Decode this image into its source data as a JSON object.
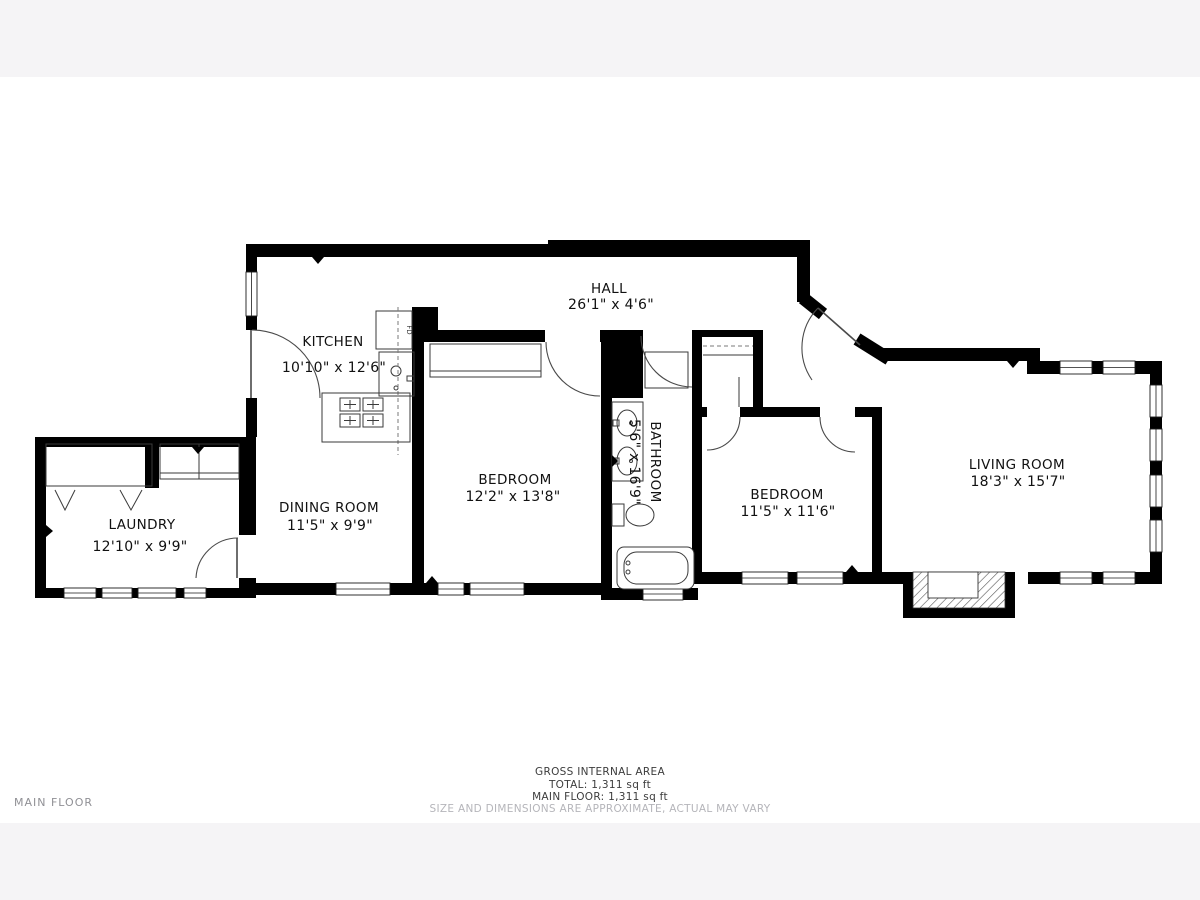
{
  "colors": {
    "page_bg": "#f5f4f6",
    "canvas_bg": "#ffffff",
    "wall": "#000000",
    "label": "#111111",
    "muted_label": "#909095",
    "disclaimer": "#b5b5ba"
  },
  "rooms": {
    "kitchen": {
      "name": "KITCHEN",
      "dims": "10'10\" x 12'6\""
    },
    "hall": {
      "name": "HALL",
      "dims": "26'1\" x 4'6\""
    },
    "laundry": {
      "name": "LAUNDRY",
      "dims": "12'10\" x 9'9\""
    },
    "dining": {
      "name": "DINING ROOM",
      "dims": "11'5\" x 9'9\""
    },
    "bedroom1": {
      "name": "BEDROOM",
      "dims": "12'2\" x 13'8\""
    },
    "bathroom": {
      "name": "BATHROOM",
      "dims": "5'6\" x 16'9\""
    },
    "bedroom2": {
      "name": "BEDROOM",
      "dims": "11'5\" x 11'6\""
    },
    "living": {
      "name": "LIVING ROOM",
      "dims": "18'3\" x 15'7\""
    }
  },
  "appliances": {
    "fridge": "FD"
  },
  "footer": {
    "gross_area": "GROSS INTERNAL AREA",
    "total": "TOTAL: 1,311 sq ft",
    "main_floor_area": "MAIN FLOOR: 1,311 sq ft",
    "disclaimer": "SIZE AND DIMENSIONS ARE APPROXIMATE, ACTUAL MAY VARY"
  },
  "floor_label": "MAIN FLOOR"
}
